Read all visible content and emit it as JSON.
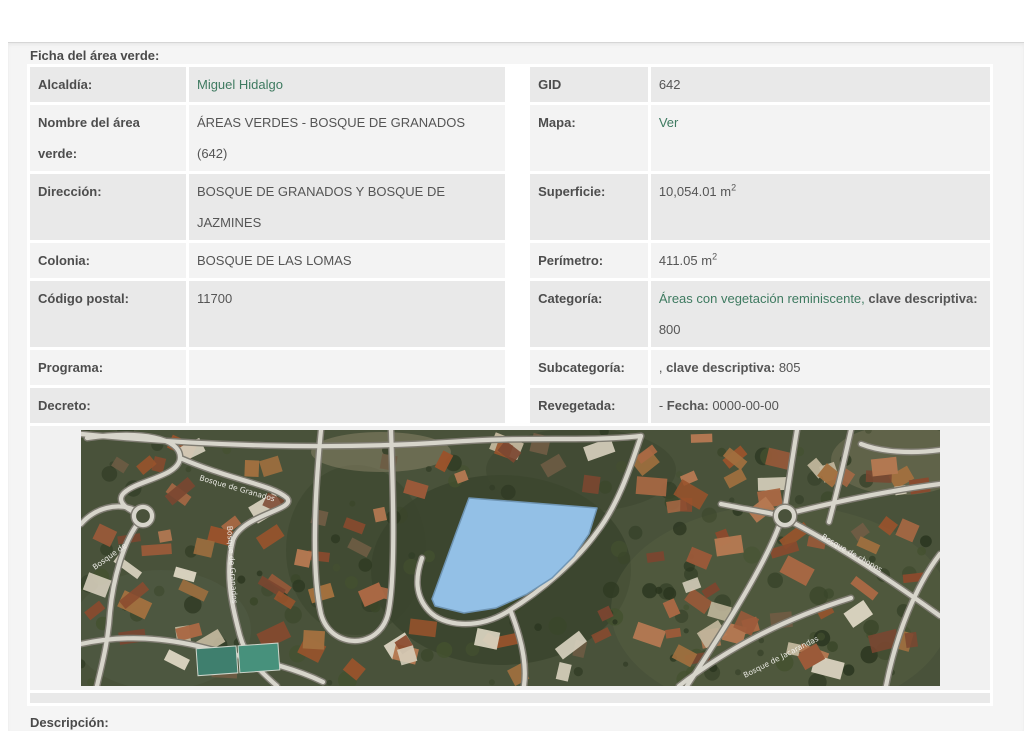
{
  "page": {
    "title": "Ficha del área verde:",
    "descripcion_title": "Descripción:"
  },
  "colors": {
    "link_green": "#3e7a60",
    "row_dark": "#e9e9e9",
    "row_light": "#f3f3f3",
    "polygon_blue": "#93c0e6"
  },
  "ficha": {
    "alcaldia": {
      "label": "Alcaldía:",
      "value": "Miguel Hidalgo"
    },
    "gid": {
      "label": "GID",
      "value": "642"
    },
    "nombre": {
      "label": "Nombre del área verde:",
      "value": "ÁREAS VERDES - BOSQUE DE GRANADOS (642)"
    },
    "mapa": {
      "label": "Mapa:",
      "value": "Ver"
    },
    "direccion": {
      "label": "Dirección:",
      "value": "BOSQUE DE GRANADOS Y BOSQUE DE JAZMINES"
    },
    "superficie": {
      "label": "Superficie:",
      "value": "10,054.01 m",
      "sup": "2"
    },
    "colonia": {
      "label": "Colonia:",
      "value": "BOSQUE DE LAS LOMAS"
    },
    "perimetro": {
      "label": "Perímetro:",
      "value": "411.05 m",
      "sup": "2"
    },
    "codigo_postal": {
      "label": "Código postal:",
      "value": "11700"
    },
    "categoria": {
      "label": "Categoría:",
      "link": "Áreas con vegetación reminiscente,",
      "bold": "clave descriptiva:",
      "value": "800"
    },
    "programa": {
      "label": "Programa:",
      "value": ""
    },
    "subcategoria": {
      "label": "Subcategoría:",
      "prefix": ",",
      "bold": "clave descriptiva:",
      "value": "805"
    },
    "decreto": {
      "label": "Decreto:",
      "value": ""
    },
    "revegetada": {
      "label": "Revegetada:",
      "prefix": "-",
      "bold": "Fecha:",
      "value": "0000-00-00"
    }
  },
  "map": {
    "street_labels": [
      "Bosque de Granados",
      "Bosque de Granados",
      "Bosque de chopos",
      "Bosque de Jacarandas",
      "Bosque de"
    ],
    "polygon_points": "388,68 516,78 508,104 493,126 471,148 446,164 415,178 383,183 354,176 351,169 363,136 375,103"
  }
}
